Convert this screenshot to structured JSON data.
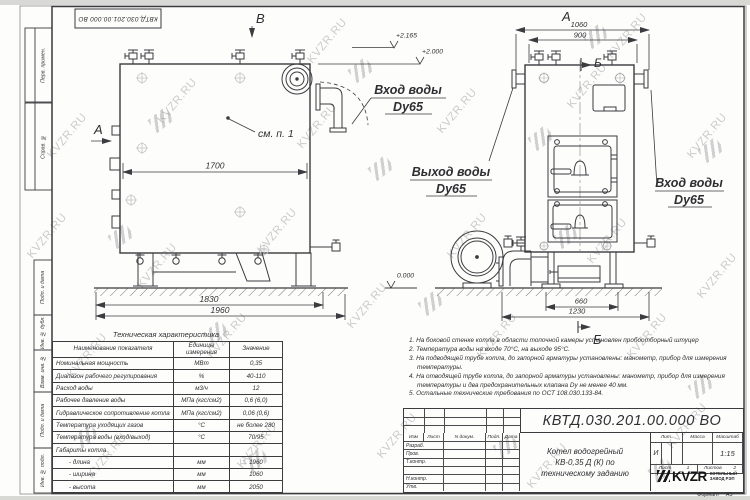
{
  "watermark": {
    "text": "KVZR.RU"
  },
  "frame": {
    "left_columns": [
      "Перв. примен.",
      "Справ. №",
      "Подп. и дата",
      "Инв. № дубл.",
      "Взам. инв. №",
      "Подп. и дата",
      "Инв. № подл."
    ]
  },
  "views": {
    "view_marker_a": "А",
    "view_marker_b": "Б",
    "view_marker_v": "В",
    "callout_see_item": "см. п. 1",
    "elevations": {
      "valve_top": "+2.165",
      "boiler_top": "+2.000",
      "ground": "0.000"
    },
    "dims": {
      "left_inner": "1700",
      "left_legs": "1830",
      "left_total": "1960",
      "front_total": "1060",
      "front_inner": "900",
      "base_inner": "660",
      "base_total": "1230"
    },
    "pipe_labels": {
      "inlet_top": {
        "l1": "Вход воды",
        "l2": "Dy65"
      },
      "outlet": {
        "l1": "Выход воды",
        "l2": "Dy65"
      },
      "inlet_right": {
        "l1": "Вход воды",
        "l2": "Dy65"
      }
    }
  },
  "spec_table": {
    "title": "Техническая характеристика",
    "headers": [
      "Наименование показателя",
      "Единицы измерения",
      "Значение"
    ],
    "rows": [
      [
        "Номинальная мощность",
        "МВт",
        "0,35"
      ],
      [
        "Диапазон рабочего регулирования",
        "%",
        "40-110"
      ],
      [
        "Расход воды",
        "м3/ч",
        "12"
      ],
      [
        "Рабочее давление воды",
        "МПа (кгс/см2)",
        "0,6 (6,0)"
      ],
      [
        "Гидравлическое сопротивление котла",
        "МПа (кгс/см2)",
        "0,06 (0,6)"
      ],
      [
        "Температура уходящих газов",
        "°С",
        "не более 280"
      ],
      [
        "Температура воды (вход/выход)",
        "°С",
        "70/95"
      ],
      [
        "Габариты котла",
        "",
        ""
      ],
      [
        "- длина",
        "мм",
        "1960"
      ],
      [
        "- ширина",
        "мм",
        "1060"
      ],
      [
        "- высота",
        "мм",
        "2050"
      ]
    ]
  },
  "notes": [
    "1. На боковой стенке котла в области топочной камеры установлен пробоотборный штуцер",
    "2. Температура воды на входе 70°С, на выходе 95°С.",
    "3. На подводящей трубе котла, до запорной арматуры установлены: манометр, прибор для измерения температуры.",
    "4. На отводящей трубе котла, до запорной арматуры установлены: манометр, прибор для измерения температуры и два предохранительных клапана Dу не менее 40 мм.",
    "5. Остальные технические требования по ОСТ 108.030.133-84."
  ],
  "title_block": {
    "doc_number": "КВТД.030.201.00.000  ВО",
    "header_cols": [
      "Изм",
      "Лист",
      "N докум.",
      "Подп.",
      "Дата"
    ],
    "sign_labels": [
      "Разраб.",
      "Пров.",
      "Т.контр.",
      "",
      "Н.контр.",
      "Утв."
    ],
    "title_line1": "Котел водогрейный",
    "title_line2": "КВ-0,35 Д (К) по",
    "title_line3": "техническому заданию",
    "lit_header": "Лит.",
    "mass_header": "Масса",
    "scale_header": "Масштаб",
    "lit_value": "И",
    "scale_value": "1:15",
    "sheet_label": "Лист",
    "sheet_value": "1",
    "sheets_label": "Листов",
    "sheets_value": "2",
    "company_logo": "KVZR",
    "company_name_line1": "КОТЕЛЬНЫЙ",
    "company_name_line2": "ЗАВОД РЭП",
    "format_label": "Формат",
    "format_value": "А3"
  }
}
